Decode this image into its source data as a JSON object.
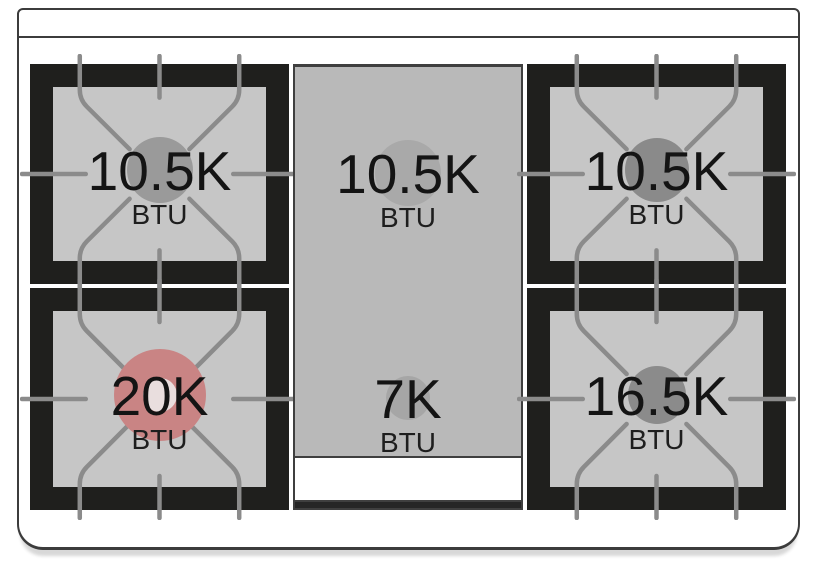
{
  "burners": {
    "top_left": {
      "value": "10.5K",
      "unit": "BTU"
    },
    "top_center": {
      "value": "10.5K",
      "unit": "BTU"
    },
    "top_right": {
      "value": "10.5K",
      "unit": "BTU"
    },
    "bottom_left": {
      "value": "20K",
      "unit": "BTU"
    },
    "bottom_center": {
      "value": "7K",
      "unit": "BTU"
    },
    "bottom_right": {
      "value": "16.5K",
      "unit": "BTU"
    }
  },
  "colors": {
    "frame_black": "#1f1f1d",
    "grate_bed_gray": "#c6c6c6",
    "griddle_gray": "#b9b9b9",
    "grate_line_gray": "#8b8b8b",
    "outline_gray": "#3c3c3c",
    "highlight_burner_red": "#c98484",
    "burner_cap_gray": "#8a8a8a",
    "griddle_handle_white": "#ffffff",
    "text_black": "#141414"
  }
}
